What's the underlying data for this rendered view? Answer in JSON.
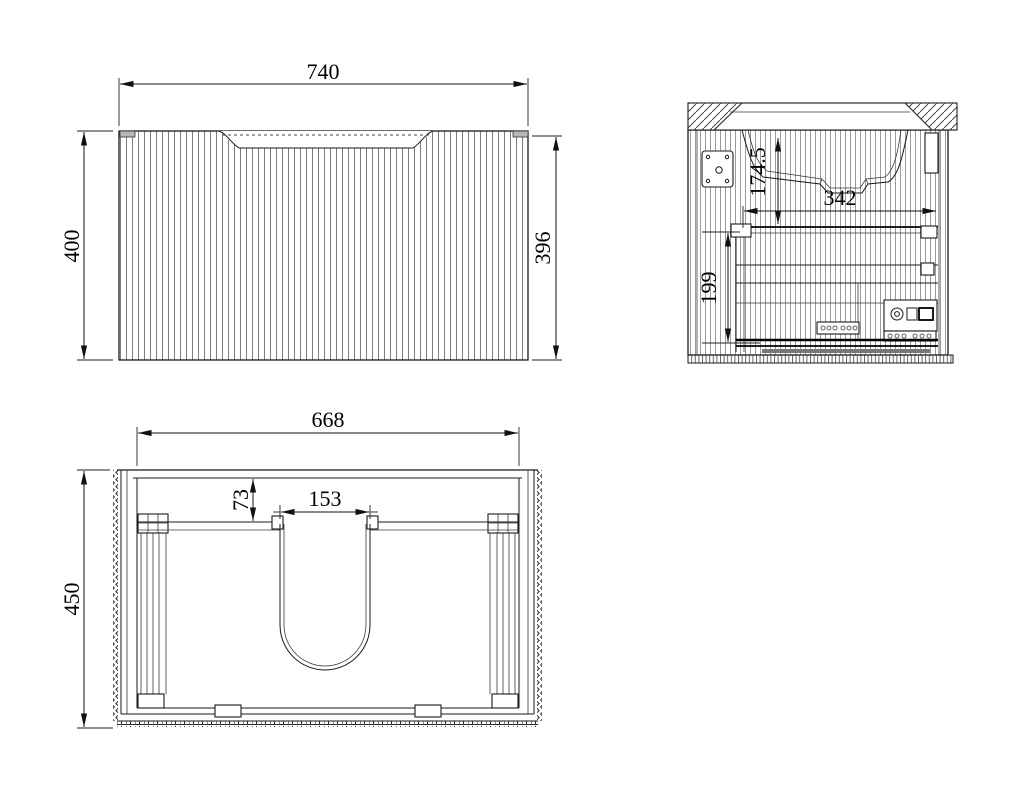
{
  "drawing": {
    "background": "#ffffff",
    "line_color": "#1a1a1a",
    "views": {
      "front": {
        "dim_width": "740",
        "dim_height_overall": "400",
        "dim_height_body": "396"
      },
      "side": {
        "dim_basin_depth": "174.5",
        "dim_internal_depth": "342",
        "dim_drawer_height": "199"
      },
      "plan": {
        "dim_internal_width": "668",
        "dim_depth": "450",
        "dim_back_offset": "73",
        "dim_cutout_width": "153"
      }
    }
  }
}
